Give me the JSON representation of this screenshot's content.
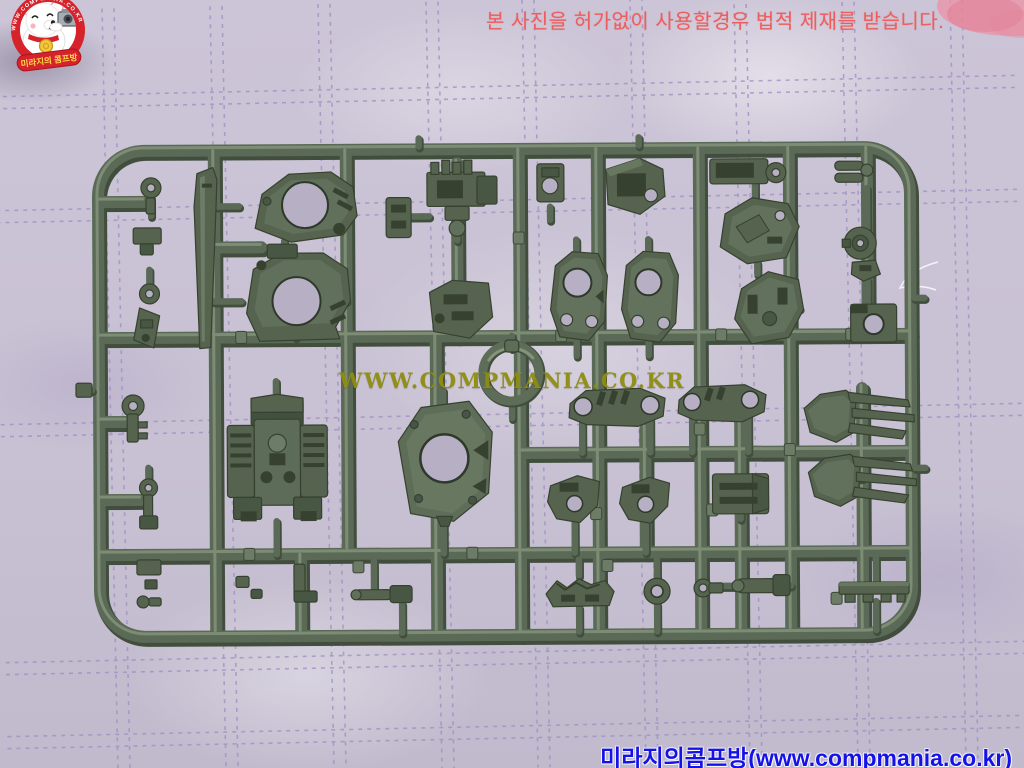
{
  "scene": {
    "type": "photograph",
    "subject": "dark olive-green plastic model kit sprue (runner) with mecha parts, lying on a lavender quilted fabric"
  },
  "top_warning": {
    "text": "본 사진을 허가없이 사용할경우 법적 제재를 받습니다.",
    "color": "#ed5f5f"
  },
  "center_watermark": {
    "text": "WWW.COMPMANIA.CO.KR",
    "color": "#8e8d10"
  },
  "bottom_credit": {
    "text": "미라지의콤프방(www.compmania.co.kr)",
    "color": "#1512e8"
  },
  "logo": {
    "ring_text": "WWW.COMPMANIA.CO.KR",
    "banner_text": "미라지의 콤프방",
    "colors": {
      "ring": "#d6222b",
      "banner": "#d6222b",
      "banner_text": "#ffd94a",
      "bear": "#ffffff",
      "camera": "#a7adb5",
      "medal": "#f5c63c"
    }
  },
  "colors": {
    "fabric": "#cbc4d6",
    "stitch": "#9d8fc2",
    "sprue_base": "#5b6a57",
    "sprue_shadow": "#414e3d",
    "sprue_highlight": "#84937a",
    "part_fill": "#55634f",
    "part_light": "#6d7c66",
    "part_dark": "#36422f",
    "hole_fabric": "#b7b0c4"
  }
}
